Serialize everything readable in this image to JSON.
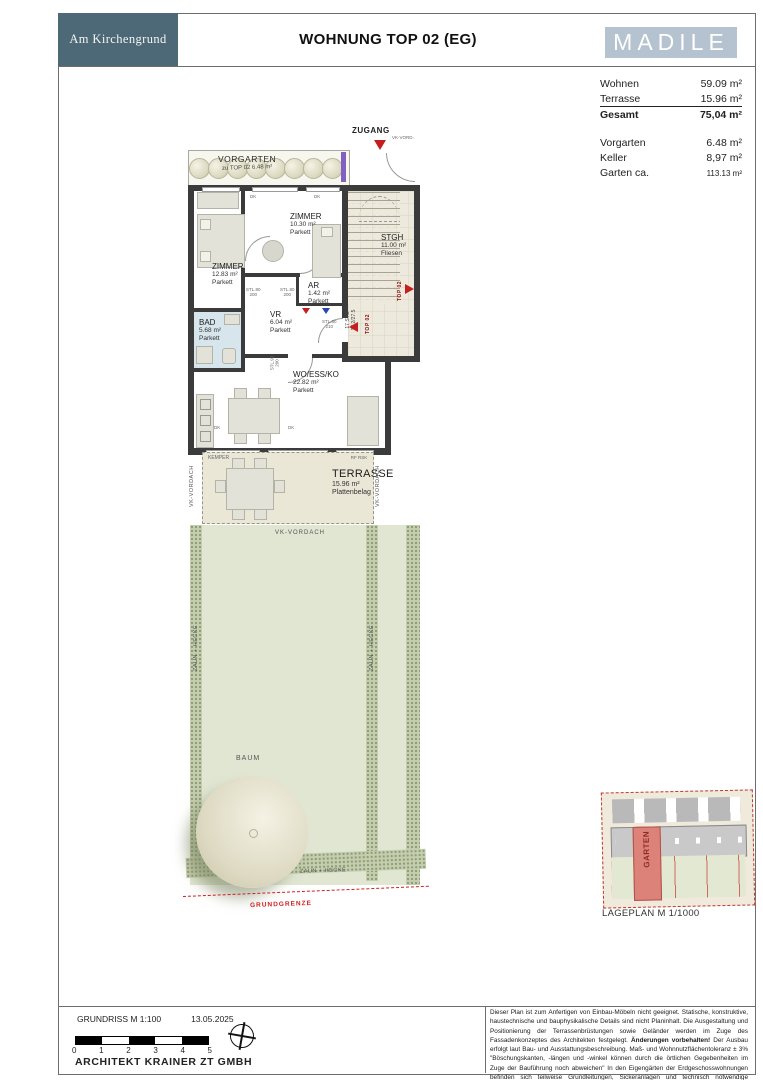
{
  "header": {
    "logo": "Am Kirchengrund",
    "title": "WOHNUNG TOP 02 (EG)",
    "brand": "MADILE"
  },
  "area_table": {
    "rows": [
      {
        "label": "Wohnen",
        "value": "59.09 m²"
      },
      {
        "label": "Terrasse",
        "value": "15.96 m²"
      },
      {
        "label": "Gesamt",
        "value": "75,04 m²"
      },
      {
        "label": "Vorgarten",
        "value": "6.48 m²"
      },
      {
        "label": "Keller",
        "value": "8,97 m²"
      },
      {
        "label": "Garten ca.",
        "value": "113.13 m²"
      }
    ]
  },
  "plan": {
    "zugang": {
      "label": "ZUGANG",
      "sub": "VK-VORD."
    },
    "vorgarten": {
      "name": "VORGARTEN",
      "info": "zu TOP 02 6.48 m²"
    },
    "rooms": [
      {
        "name": "ZIMMER",
        "area": "10.30 m²",
        "floor": "Parkett"
      },
      {
        "name": "ZIMMER",
        "area": "12.83 m²",
        "floor": "Parkett"
      },
      {
        "name": "STGH",
        "area": "11.00 m²",
        "floor": "Fliesen"
      },
      {
        "name": "AR",
        "area": "1.42 m²",
        "floor": "Parkett"
      },
      {
        "name": "VR",
        "area": "6.04 m²",
        "floor": "Parkett"
      },
      {
        "name": "BAD",
        "area": "5.68 m²",
        "floor": "Parkett"
      },
      {
        "name": "WO/ESS/KO",
        "area": "22.82 m²",
        "floor": "Parkett"
      },
      {
        "name": "TERRASSE",
        "area": "15.96 m²",
        "floor": "Plattenbelag"
      }
    ],
    "stairs": {
      "line1": "17 STG",
      "line2": "17.2/27.5"
    },
    "unit_marker": "TOP 02",
    "door_label": "DK",
    "stl_labels": [
      {
        "a": "STL.80",
        "b": "200"
      },
      {
        "a": "STL.80",
        "b": "200"
      },
      {
        "a": "STL.80",
        "b": "210"
      },
      {
        "a": "STL.90",
        "b": "200"
      }
    ],
    "terrace_labels": {
      "kemper": "KEMPER",
      "rfrsk": "RF RSK",
      "vordach": "VK-VORDACH"
    },
    "garden": {
      "vordach": "VK-VORDACH",
      "zaun": "ZAUN + HECKE",
      "baum": "BAUM",
      "grenze": "GRUNDGRENZE"
    }
  },
  "lageplan": {
    "caption": "LAGEPLAN M 1/1000",
    "garten": "GARTEN"
  },
  "footer": {
    "plan_scale": "GRUNDRISS M 1:100",
    "date": "13.05.2025",
    "ticks": [
      "0",
      "1",
      "2",
      "3",
      "4",
      "5"
    ],
    "architect": "ARCHITEKT KRAINER ZT GMBH",
    "disclaimer": {
      "p1": "Dieser Plan ist zum Anfertigen von Einbau-Möbeln nicht geeignet. Statische, konstruktive, haustechnische und bauphysikalische Details sind nicht Planinhalt. Die Ausgestaltung und Positionierung der Terrassenbrüstungen sowie Geländer werden im Zuge des Fassadenkonzeptes des Architekten festgelegt. ",
      "bold": "Änderungen vorbehalten!",
      "p2": " Der Ausbau erfolgt laut Bau- und Ausstattungsbeschreibung. Maß- und Wohnnutzflächentoleranz ± 3% \"Böschungskanten, -längen und -winkel können durch die örtlichen Gegebenheiten im Zuge der Bauführung noch abweichen\" In den Eigengärten der Erdgeschosswohnungen befinden sich teilweise Grundleitungen, Sickeranlagen und technisch notwendige Reinigungs- und Putzschächte. Die Zugänglichkeit für Reinigungszwecken ist dauerhaft zu gewährleisten!"
    }
  },
  "colors": {
    "slate": "#4d6977",
    "brand_bg": "#b5c2cf",
    "wall": "#3b3b3b",
    "accent_red": "#c41e20",
    "garden_green": "#e0e6d2",
    "stair_beige": "#edeadd",
    "bath_blue": "#d7e5ed",
    "grundgrenze_red": "#d02020"
  }
}
